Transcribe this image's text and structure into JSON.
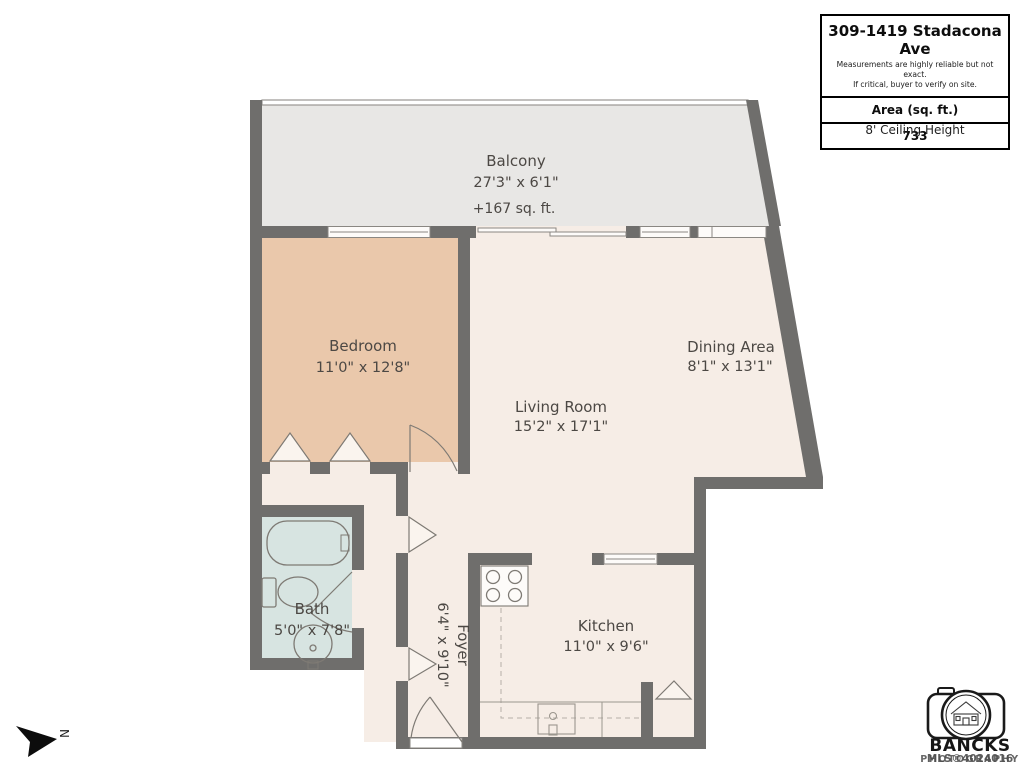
{
  "info_panel": {
    "title": "309-1419 Stadacona Ave",
    "disclaimer_line1": "Measurements are highly reliable but not exact.",
    "disclaimer_line2": "If critical, buyer to verify on site.",
    "area_label": "Area (sq. ft.)",
    "area_value": "733",
    "ceiling_height": "8' Ceiling Height"
  },
  "rooms": {
    "balcony": {
      "name": "Balcony",
      "dimensions": "27'3\" x 6'1\"",
      "area_note": "+167 sq. ft."
    },
    "bedroom": {
      "name": "Bedroom",
      "dimensions": "11'0\" x 12'8\""
    },
    "dining": {
      "name": "Dining Area",
      "dimensions": "8'1\" x 13'1\""
    },
    "living": {
      "name": "Living Room",
      "dimensions": "15'2\" x 17'1\""
    },
    "bath": {
      "name": "Bath",
      "dimensions": "5'0\" x 7'8\""
    },
    "foyer": {
      "name": "Foyer",
      "dimensions": "6'4\" x 9'10\""
    },
    "kitchen": {
      "name": "Kitchen",
      "dimensions": "11'0\" x 9'6\""
    }
  },
  "compass": {
    "label": "N"
  },
  "branding": {
    "company": "BANCKS",
    "subtext": "PHOTOGRAPHY",
    "mls": "MLS®4024016"
  },
  "colors": {
    "wall": "#6f6e6c",
    "floor": "#f6ede6",
    "bedroom": "#eac8ab",
    "bath": "#d7e4e1",
    "balcony": "#e8e7e5"
  }
}
